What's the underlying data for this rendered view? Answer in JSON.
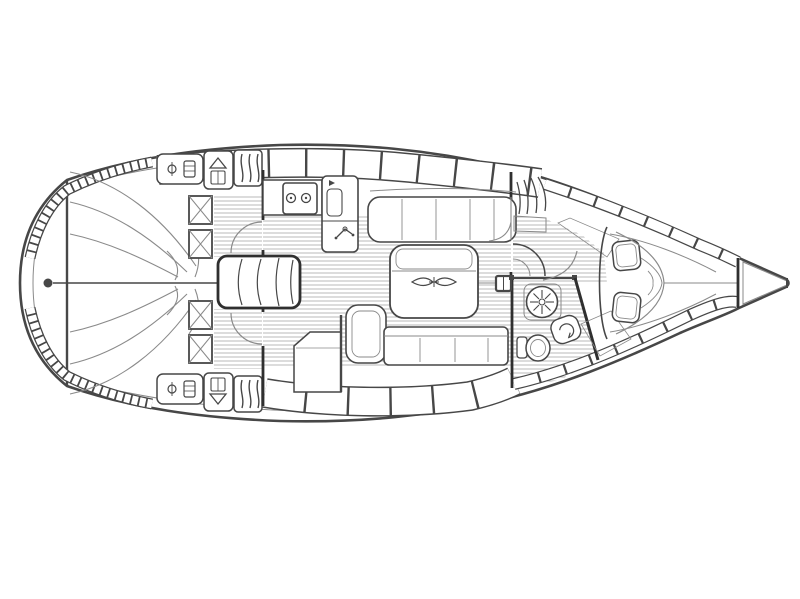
{
  "canvas": {
    "width": 800,
    "height": 599,
    "background": "#ffffff"
  },
  "colors": {
    "paper": "#ffffff",
    "line": "#474747",
    "line_light": "#8a8a8a",
    "floor_stripe": "#b9b9b9",
    "hatch": "#7a7a7a",
    "dark": "#2f2f2f"
  },
  "diagram": {
    "type": "sailboat-interior-floor-plan",
    "orientation": {
      "bow": "right",
      "stern": "left"
    },
    "regions": [
      "stern-platform",
      "aft-cabin-port-berth",
      "aft-cabin-starboard-berth",
      "companionway-steps",
      "galley",
      "salon",
      "storage-cabinet",
      "head-compartment",
      "forward-v-berth-cabin",
      "anchor-locker"
    ],
    "fixtures": [
      "rudder-post-dot",
      "deck-hatch-icons",
      "vent-box-icons",
      "louver-box-icon",
      "stove-two-burner-icon",
      "galley-sink-faucet-icon",
      "folding-table-hinge-icon",
      "mast-post",
      "shower-rose-icon",
      "toilet-icon",
      "washbasin-icon",
      "wardrobe-louver-lines",
      "quarter-round-seat",
      "v-berth-pillows",
      "toe-rail-segments",
      "locker-band-segments"
    ]
  }
}
